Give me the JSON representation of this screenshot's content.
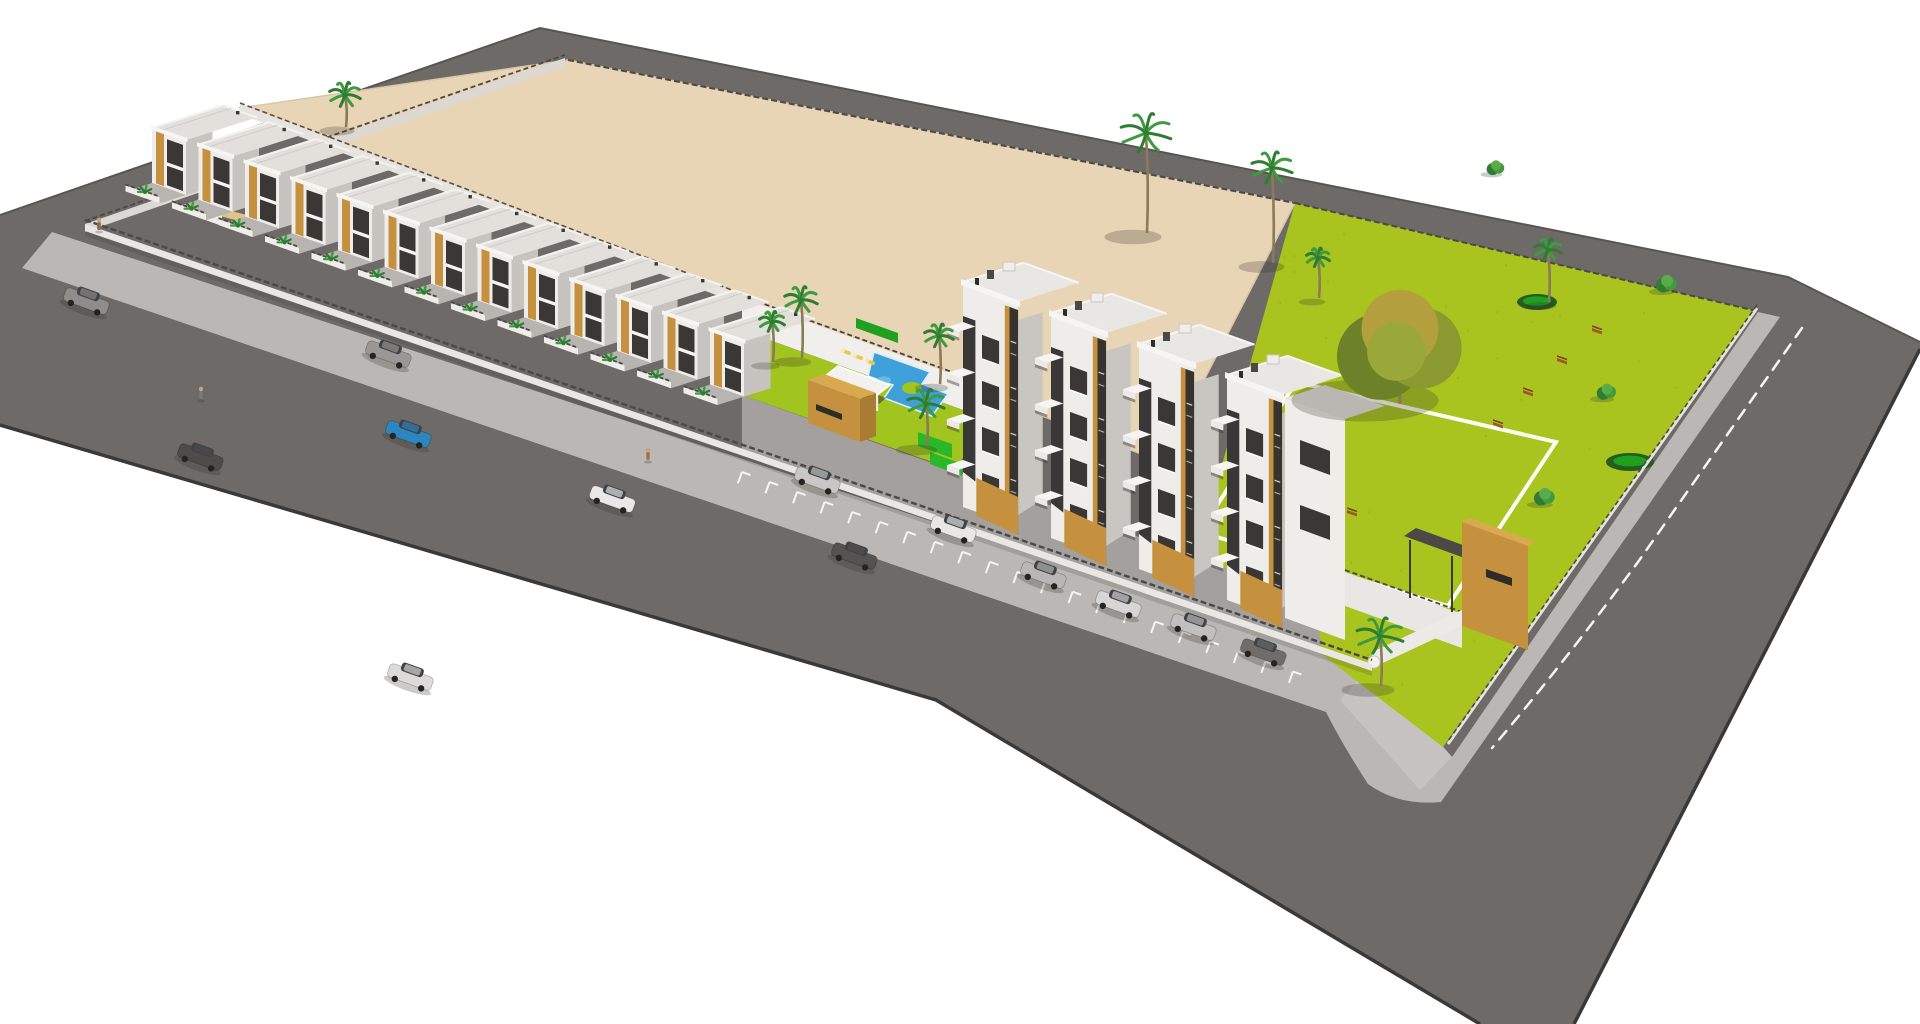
{
  "meta": {
    "alt": "Aerial 3D architectural rendering of a residential development: a long row of white townhouses with wood-tone accents, four-storey apartment towers with stacked balconies, a communal swimming pool with lawn and palms, a bright green landscaped park with paths and benches, a large vacant sand-coloured plot behind, and perimeter streets with parked cars."
  },
  "colors": {
    "background": "#ffffff",
    "road": "#6e6a68",
    "curb": "#3b3938",
    "road_top_edge": "#59554f",
    "sidewalk": "#bab7b4",
    "lot": "#e8d5b6",
    "lot_edge": "#d9c6a6",
    "park": "#a9c41f",
    "park_speckle": "#93b217",
    "lawn": "#a2c41e",
    "pool": "#3f9fd9",
    "pool_light": "#79bfe8",
    "pool_rim": "#d9eef9",
    "white_wall": "#efedea",
    "white_bright": "#f6f5f3",
    "wall_shade": "#d8d5d1",
    "wall_dark": "#c7c4c0",
    "roof": "#e3e0dc",
    "court": "#a3a09d",
    "yard": "#b8b5b1",
    "tan": "#c6913e",
    "tan_dark": "#a87c32",
    "tan_light": "#d9a94f",
    "window": "#3a3734",
    "recess": "#2e2b29",
    "hedge_dark": "#1fa01f",
    "hedge_bright": "#2ab828",
    "palm_green": "#3f9b3f",
    "palm_dark": "#2e7d32",
    "trunk": "#8a7a55",
    "tree_olive": "#8a9a30",
    "tree_gold": "#b3a03c",
    "tree_shade": "#6d8129",
    "bench": "#a05a2a",
    "marking": "#f5f5f4",
    "shadow": "rgba(50,48,40,0.25)",
    "lounger": "#e8c84a",
    "sand_path": "#dfc489"
  },
  "site": {
    "townhouses": {
      "count": 13,
      "start": [
        152,
        128
      ],
      "step": [
        46.5,
        16.8
      ]
    },
    "apartment_towers": {
      "count": 4,
      "start": [
        963,
        282
      ],
      "step": [
        88,
        31
      ],
      "floors": 4,
      "height": 225,
      "width": 58
    },
    "cars": [
      {
        "x": 86,
        "y": 302,
        "color": "#8f8c8a"
      },
      {
        "x": 200,
        "y": 458,
        "color": "#4e4b49"
      },
      {
        "x": 388,
        "y": 355,
        "color": "#9a9795"
      },
      {
        "x": 408,
        "y": 435,
        "color": "#2d86c0"
      },
      {
        "x": 410,
        "y": 678,
        "color": "#dddbd9"
      },
      {
        "x": 612,
        "y": 500,
        "color": "#e9e8e6"
      },
      {
        "x": 817,
        "y": 481,
        "color": "#c9c7c5"
      },
      {
        "x": 854,
        "y": 557,
        "color": "#55524f"
      },
      {
        "x": 953,
        "y": 530,
        "color": "#e8e7e5"
      },
      {
        "x": 1043,
        "y": 576,
        "color": "#b9b7b5"
      },
      {
        "x": 1118,
        "y": 605,
        "color": "#d8d6d4"
      },
      {
        "x": 1193,
        "y": 628,
        "color": "#c2c0be"
      },
      {
        "x": 1263,
        "y": 653,
        "color": "#6f6c69"
      }
    ],
    "pedestrians": [
      {
        "x": 99,
        "y": 222,
        "color": "#8a6a4a"
      },
      {
        "x": 201,
        "y": 391,
        "color": "#7a7a7a"
      },
      {
        "x": 648,
        "y": 452,
        "color": "#a07848"
      }
    ],
    "benches": [
      [
        1597,
        330
      ],
      [
        1562,
        360
      ],
      [
        1528,
        392
      ],
      [
        1498,
        424
      ],
      [
        1352,
        512
      ],
      [
        1318,
        555
      ],
      [
        1286,
        598
      ]
    ],
    "park_trees": [
      {
        "type": "palm",
        "x": 1146,
        "y": 133,
        "r": 26,
        "trunk": 100
      },
      {
        "type": "palm",
        "x": 1272,
        "y": 168,
        "r": 21,
        "trunk": 95
      },
      {
        "type": "palm",
        "x": 1318,
        "y": 258,
        "r": 12,
        "trunk": 40
      },
      {
        "type": "palm",
        "x": 1548,
        "y": 250,
        "r": 14,
        "trunk": 52
      },
      {
        "type": "round",
        "x": 1400,
        "y": 348,
        "r": 70
      },
      {
        "type": "bush",
        "x": 1667,
        "y": 284,
        "r": 13
      },
      {
        "type": "bush",
        "x": 1607,
        "y": 392,
        "r": 12
      },
      {
        "type": "bush",
        "x": 1545,
        "y": 497,
        "r": 13
      },
      {
        "type": "bush",
        "x": 1496,
        "y": 168,
        "r": 11
      },
      {
        "type": "palm",
        "x": 1380,
        "y": 636,
        "r": 24,
        "trunk": 50
      }
    ],
    "pool_palms": [
      {
        "x": 772,
        "y": 322,
        "r": 13,
        "trunk": 40
      },
      {
        "x": 801,
        "y": 300,
        "r": 17,
        "trunk": 58
      },
      {
        "x": 939,
        "y": 336,
        "r": 15,
        "trunk": 48
      },
      {
        "x": 926,
        "y": 404,
        "r": 19,
        "trunk": 42
      },
      {
        "x": 345,
        "y": 95,
        "r": 16,
        "trunk": 32
      }
    ],
    "park_paths": {
      "rect": [
        [
          1296,
          382
        ],
        [
          1556,
          442
        ],
        [
          1448,
          606
        ],
        [
          1200,
          532
        ]
      ],
      "beds": [
        [
          1537,
          302,
          20,
          8
        ],
        [
          1630,
          462,
          24,
          9
        ]
      ]
    },
    "parking": {
      "start": [
        742,
        472
      ],
      "count": 21,
      "step": 29
    }
  }
}
